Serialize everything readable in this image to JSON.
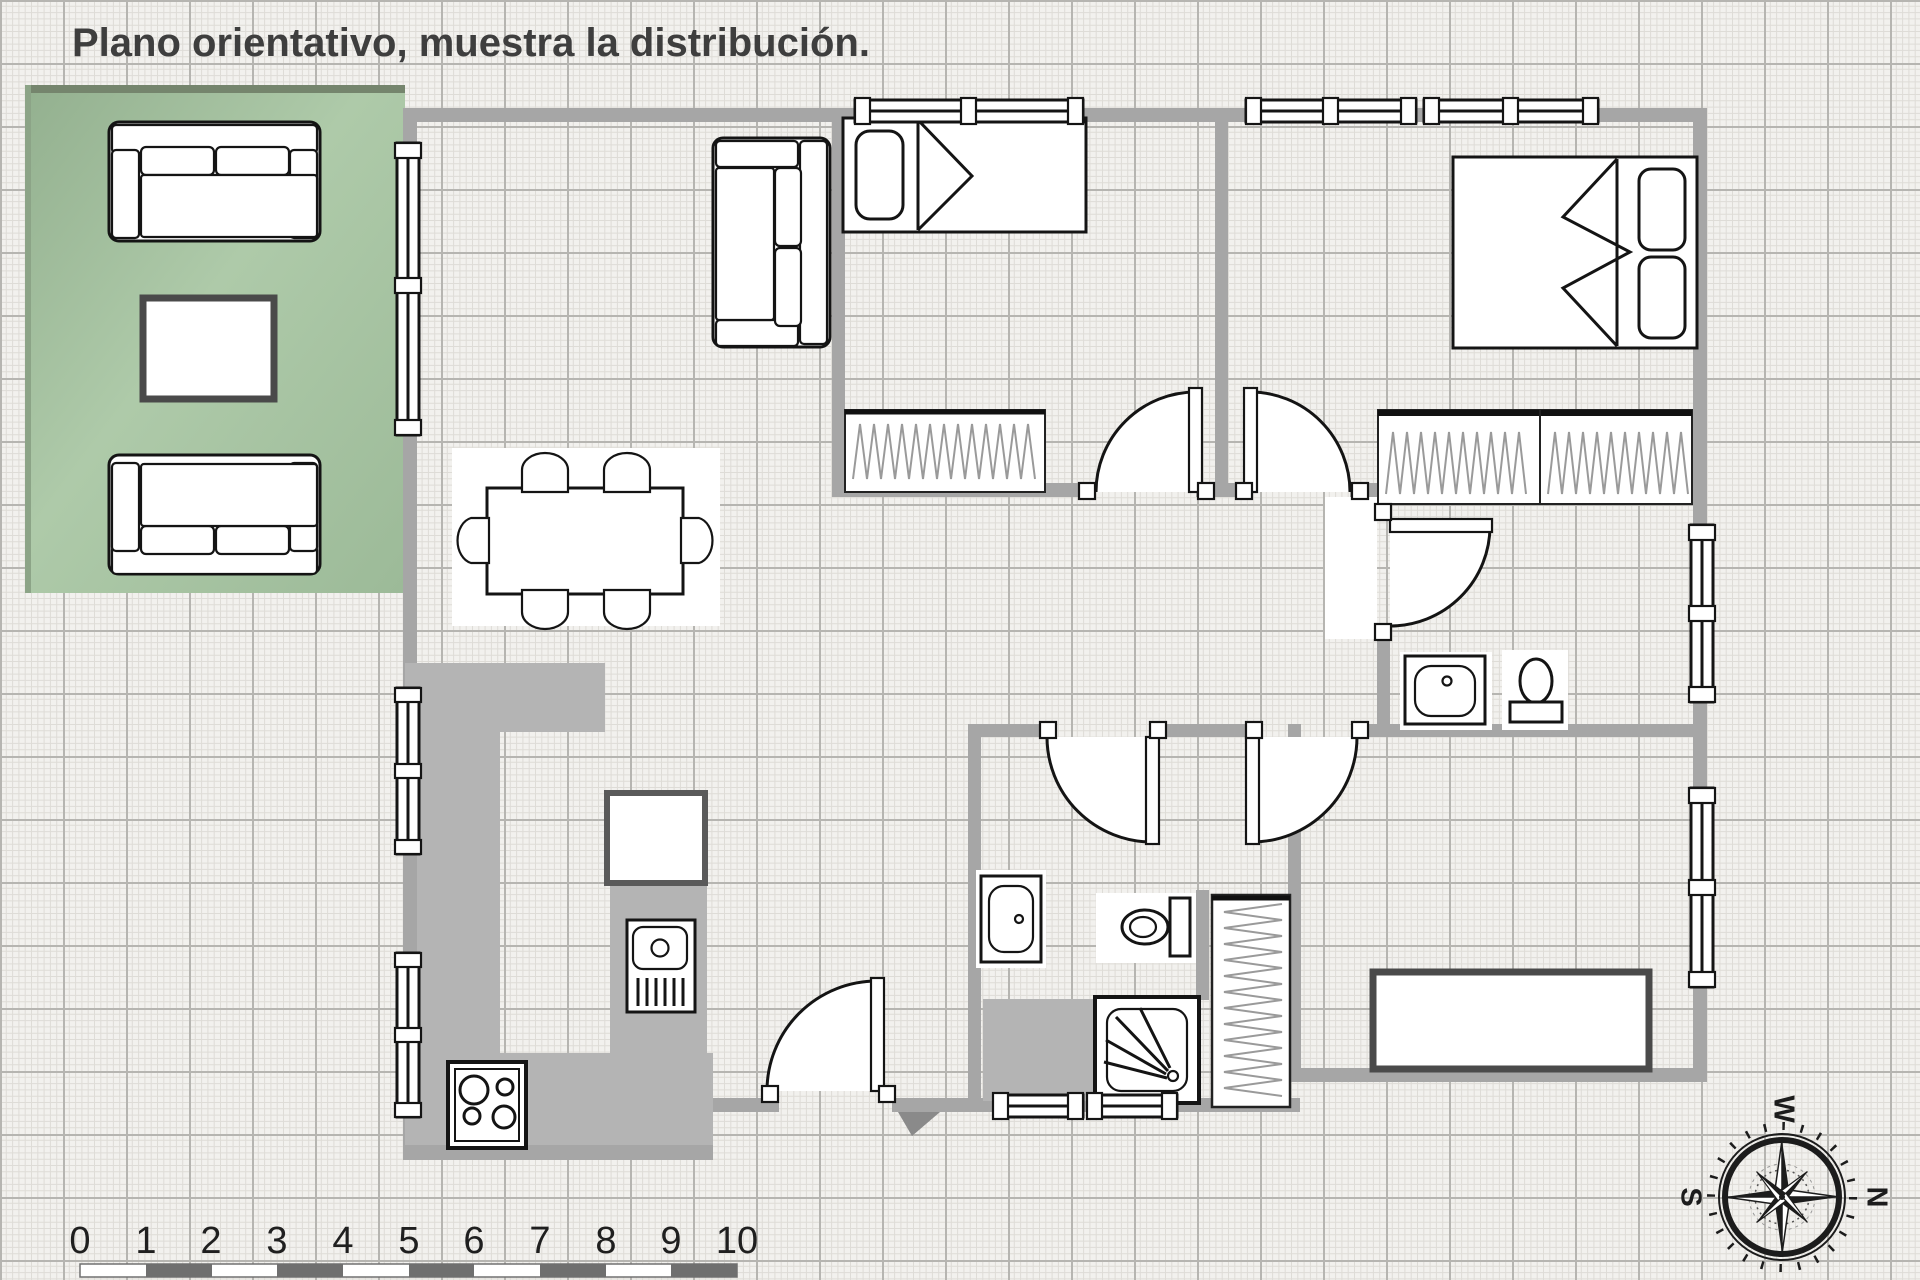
{
  "title": "Plano orientativo, muestra la distribución.",
  "scale_ruler": {
    "labels": [
      "0",
      "1",
      "2",
      "3",
      "4",
      "5",
      "6",
      "7",
      "8",
      "9",
      "10"
    ],
    "bar_dark_color": "#6f6f6f",
    "bar_light_color": "#ffffff"
  },
  "compass": {
    "top": "W",
    "right": "N",
    "left": "S"
  },
  "colors": {
    "paper": "#f1f0ed",
    "grid_minor": "#dedcd7",
    "grid_major": "#b6b5b1",
    "wall": "#a6a6a6",
    "kitchen_counter": "#b4b4b4",
    "terrace_green": "#aecaa9",
    "terrace_green_dark": "#93b08f",
    "line": "#141414",
    "furniture_border_dark": "#4a4a4a",
    "title_color": "#3e3e3e"
  },
  "icons": {
    "compass_rose": "compass-rose-icon",
    "stove": "stove-burners-icon",
    "shower": "shower-spray-icon",
    "sink": "washbasin-icon",
    "toilet": "toilet-icon",
    "wardrobe": "hanging-rail-icon"
  }
}
